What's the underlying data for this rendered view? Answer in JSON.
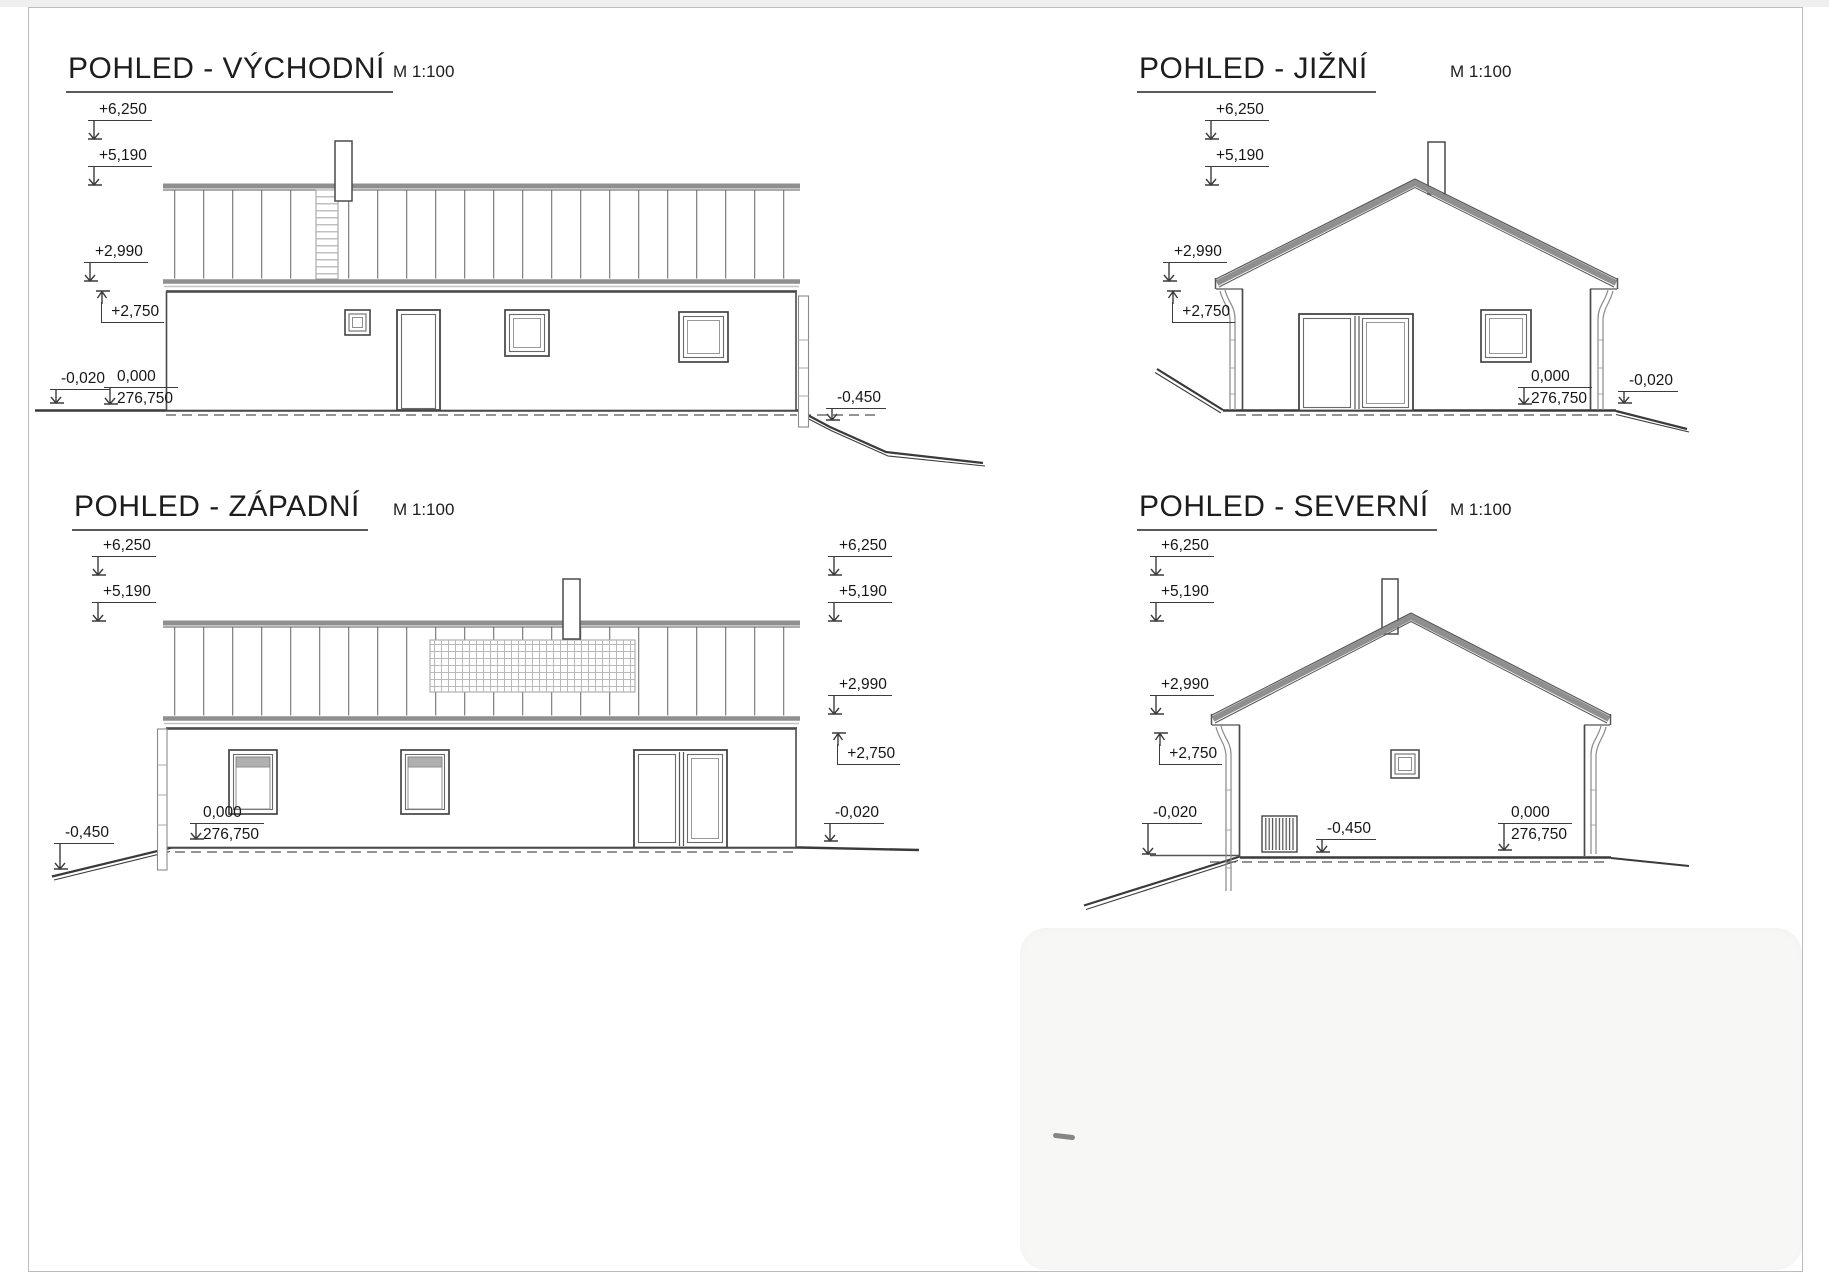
{
  "sheet": {
    "kind": "architectural elevations",
    "views": [
      {
        "id": "east",
        "title": "POHLED - VÝCHODNÍ",
        "scale": "M 1:100"
      },
      {
        "id": "south",
        "title": "POHLED - JIŽNÍ",
        "scale": "M 1:100"
      },
      {
        "id": "west",
        "title": "POHLED - ZÁPADNÍ",
        "scale": "M 1:100"
      },
      {
        "id": "north",
        "title": "POHLED - SEVERNÍ",
        "scale": "M 1:100"
      }
    ],
    "levels": {
      "ridge": "+6,250",
      "chimney": "+5,190",
      "eave_top": "+2,990",
      "eave_bottom": "+2,750",
      "zero": "0,000",
      "datum": "276,750",
      "terrain_near": "-0,020",
      "terrain_low": "-0,450"
    },
    "colors": {
      "linework": "#3c3c3c",
      "roof_gray": "#8f8f8f",
      "paper": "#ffffff"
    }
  }
}
